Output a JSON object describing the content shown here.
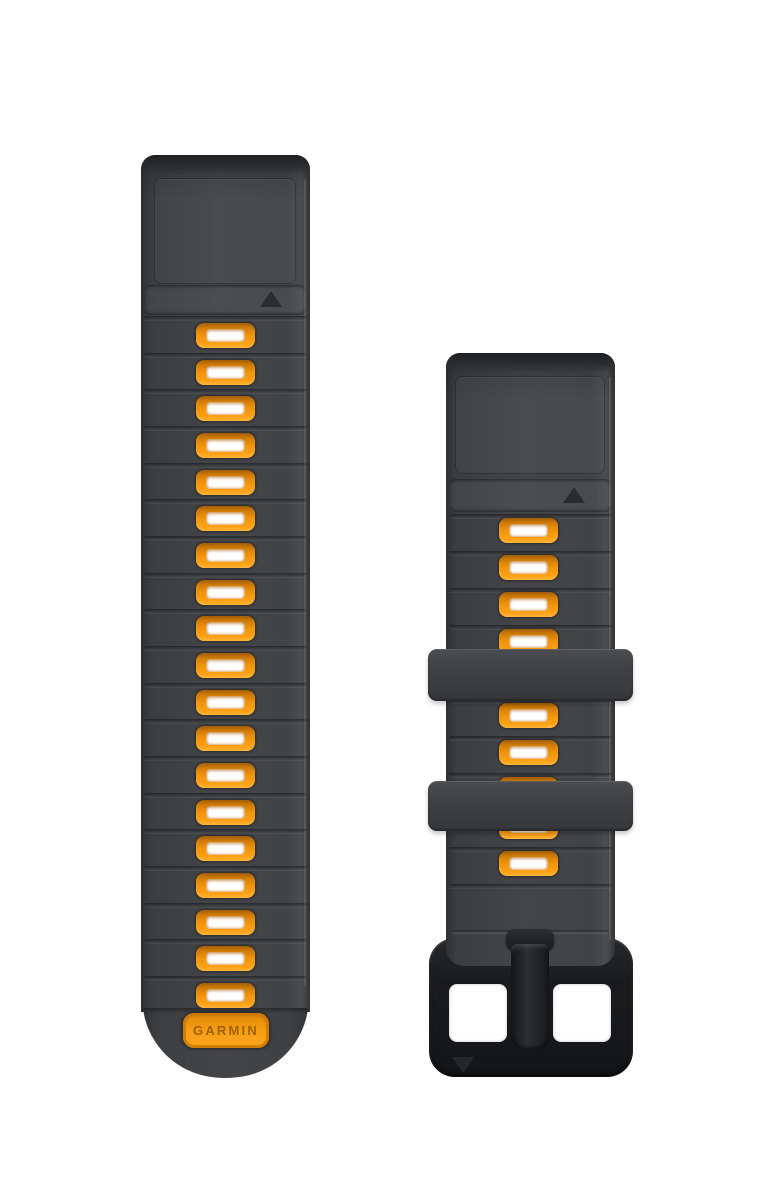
{
  "product": {
    "brand_label": "GARMIN",
    "item": "Garmin QuickFit watch band, graphite silicone with flame orange vent accents and black buckle",
    "view": "two strap halves photographed on white background"
  },
  "colors": {
    "background": "#ffffff",
    "strap_graphite": "#3f4145",
    "strap_graphite_dark": "#2d2f32",
    "strap_graphite_light": "#4b4d50",
    "vent_orange": "#f0940c",
    "vent_orange_highlight": "#ffab24",
    "vent_orange_shadow": "#a05c05",
    "vent_hole_white": "#ffffff",
    "logo_plate_orange": "#f89f16",
    "logo_text_orange": "#9d6403",
    "buckle_black": "#1b1c1f"
  },
  "left_strap": {
    "role": "long band half with logo tip",
    "vent_count": 19,
    "marker": "triangle-up",
    "logo_label": "GARMIN"
  },
  "right_strap": {
    "role": "short band half with buckle",
    "vent_count": 10,
    "keeper_count": 2,
    "marker": "triangle-up",
    "buckle_marker": "triangle-down"
  }
}
